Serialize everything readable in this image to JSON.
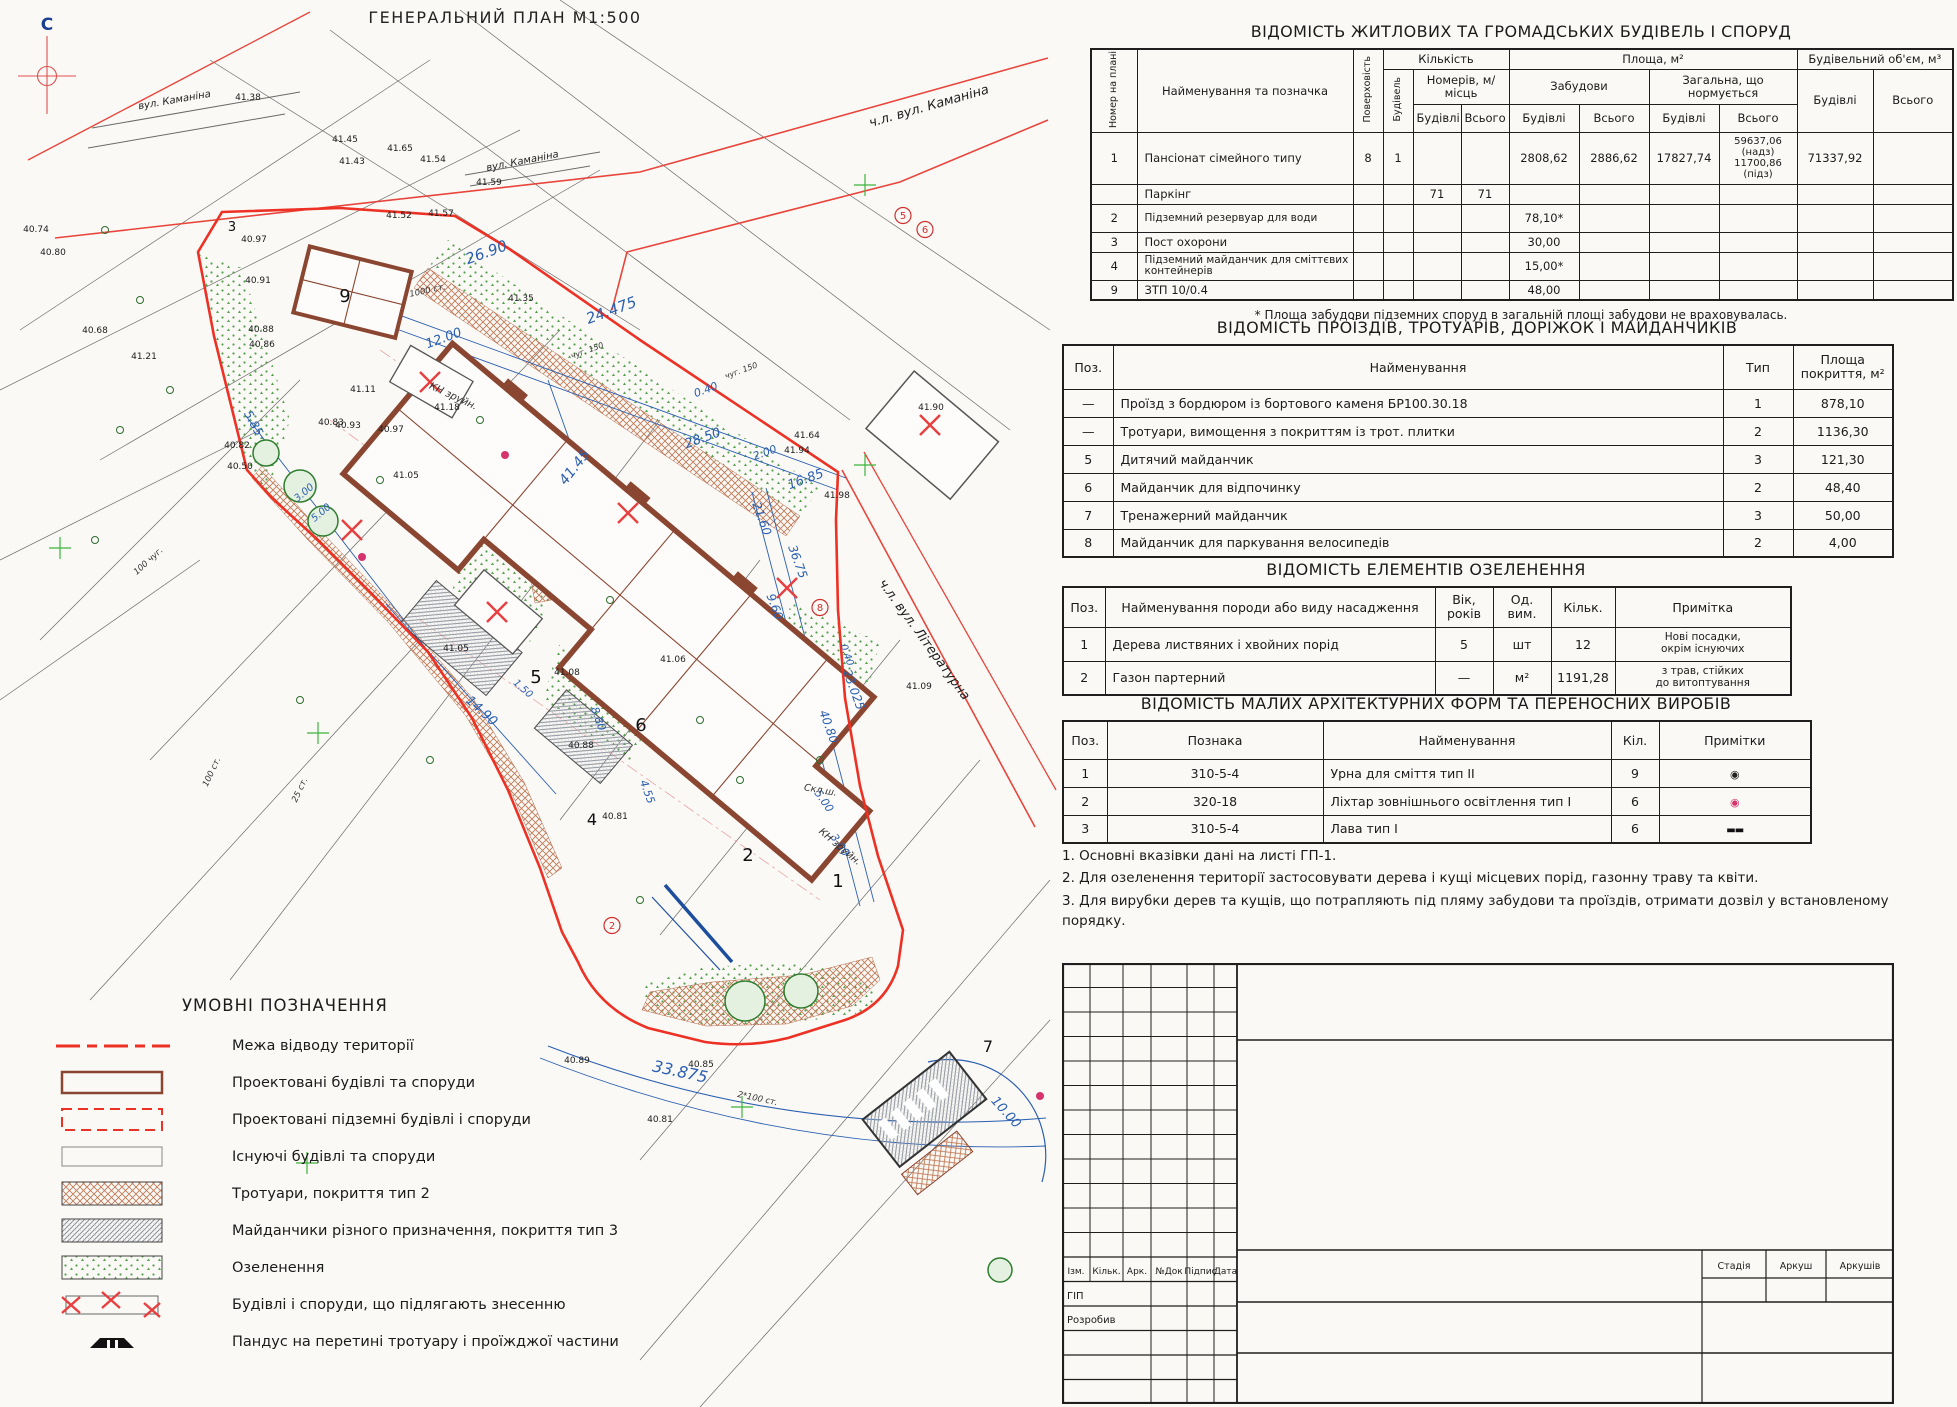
{
  "page": {
    "plan_title": "ГЕНЕРАЛЬНИЙ ПЛАН М1:500"
  },
  "tables": {
    "buildings": {
      "title": "ВІДОМІСТЬ ЖИТЛОВИХ ТА ГРОМАДСЬКИХ БУДІВЕЛЬ І СПОРУД",
      "headers": {
        "num": "Номер на плані",
        "name": "Найменування та позначка",
        "floors": "Поверховість",
        "qty": "Кількість",
        "bld_count": "Будівель",
        "rooms": "Номерів, м/місць",
        "area": "Площа, м²",
        "built": "Забудови",
        "total_norm": "Загальна, що нормується",
        "volume": "Будівельний об'єм, м³",
        "bld": "Будівлі",
        "all": "Всього"
      },
      "rows": [
        {
          "n": "1",
          "name": "Пансіонат сімейного типу",
          "fl": "8",
          "qb": "1",
          "zb": "2808,62",
          "zv": "2886,62",
          "gb": "17827,74",
          "gv": "59637,06\n(надз)\n11700,86\n(підз)",
          "vb": "71337,92"
        },
        {
          "n": "",
          "name": "Паркінг",
          "nb": "71",
          "nv": "71"
        },
        {
          "n": "2",
          "name": "Підземний резервуар для води",
          "zb": "78,10*"
        },
        {
          "n": "3",
          "name": "Пост охорони",
          "zb": "30,00"
        },
        {
          "n": "4",
          "name": "Підземний майданчик для сміттєвих контейнерів",
          "zb": "15,00*"
        },
        {
          "n": "9",
          "name": "ЗТП 10/0.4",
          "zb": "48,00"
        }
      ],
      "footnote": "* Площа забудови підземних споруд в загальній площі забудови не враховувалась."
    },
    "drives": {
      "title": "ВІДОМІСТЬ ПРОЇЗДІВ, ТРОТУАРІВ, ДОРІЖОК І МАЙДАНЧИКІВ",
      "headers": {
        "pos": "Поз.",
        "name": "Найменування",
        "type": "Тип",
        "area": "Площа\nпокриття, м²"
      },
      "rows": [
        {
          "p": "—",
          "n": "Проїзд з бордюром із бортового каменя БР100.30.18",
          "t": "1",
          "a": "878,10"
        },
        {
          "p": "—",
          "n": "Тротуари, вимощення з покриттям із трот. плитки",
          "t": "2",
          "a": "1136,30"
        },
        {
          "p": "5",
          "n": "Дитячий майданчик",
          "t": "3",
          "a": "121,30"
        },
        {
          "p": "6",
          "n": "Майданчик для відпочинку",
          "t": "2",
          "a": "48,40"
        },
        {
          "p": "7",
          "n": "Тренажерний майданчик",
          "t": "3",
          "a": "50,00"
        },
        {
          "p": "8",
          "n": "Майданчик для паркування велосипедів",
          "t": "2",
          "a": "4,00"
        }
      ]
    },
    "greenery": {
      "title": "ВІДОМІСТЬ ЕЛЕМЕНТІВ ОЗЕЛЕНЕННЯ",
      "headers": {
        "pos": "Поз.",
        "name": "Найменування породи або виду насадження",
        "age": "Вік,\nроків",
        "unit": "Од.\nвим.",
        "qty": "Кільк.",
        "note": "Примітка"
      },
      "rows": [
        {
          "p": "1",
          "n": "Дерева листвяних і хвойних порід",
          "a": "5",
          "u": "шт",
          "q": "12",
          "note": "Нові посадки,\nокрім існуючих"
        },
        {
          "p": "2",
          "n": "Газон партерний",
          "a": "—",
          "u": "м²",
          "q": "1191,28",
          "note": "з трав, стійких\nдо витоптування"
        }
      ]
    },
    "maf": {
      "title": "ВІДОМІСТЬ МАЛИХ АРХІТЕКТУРНИХ ФОРМ ТА ПЕРЕНОСНИХ ВИРОБІВ",
      "headers": {
        "pos": "Поз.",
        "mark": "Познака",
        "name": "Найменування",
        "qty": "Кіл.",
        "notes": "Примітки"
      },
      "rows": [
        {
          "p": "1",
          "m": "310-5-4",
          "n": "Урна для сміття тип II",
          "q": "9",
          "sym": "◉"
        },
        {
          "p": "2",
          "m": "320-18",
          "n": "Ліхтар зовнішнього освітлення тип I",
          "q": "6",
          "sym": "◉"
        },
        {
          "p": "3",
          "m": "310-5-4",
          "n": "Лава тип I",
          "q": "6",
          "sym": "▬▬"
        }
      ]
    }
  },
  "notes": [
    "1. Основні вказівки дані на листі ГП-1.",
    "2. Для озеленення території застосовувати дерева і кущі місцевих порід, газонну траву та квіти.",
    "3. Для вирубки дерев та кущів, що потрапляють під пляму забудови та проїздів, отримати дозвіл у встановленому порядку."
  ],
  "legend": {
    "title": "УМОВНІ ПОЗНАЧЕННЯ",
    "items": [
      {
        "label": "Межа відводу території"
      },
      {
        "label": "Проектовані будівлі та споруди"
      },
      {
        "label": "Проектовані підземні будівлі і споруди"
      },
      {
        "label": "Існуючі будівлі та споруди"
      },
      {
        "label": "Тротуари, покриття тип 2"
      },
      {
        "label": "Майданчики різного призначення, покриття тип 3"
      },
      {
        "label": "Озеленення"
      },
      {
        "label": "Будівлі і споруди, що підлягають знесенню"
      },
      {
        "label": "Пандус на перетині тротуару і проїжджої частини"
      }
    ]
  },
  "stamp": {
    "cols": [
      "Ізм.",
      "Кільк.",
      "Арк.",
      "№Док",
      "Підпис",
      "Дата"
    ],
    "roles": [
      "ГІП",
      "Розробив"
    ],
    "right": [
      "Стадія",
      "Аркуш",
      "Аркушів"
    ]
  },
  "colors": {
    "boundary_red": "#ed3124",
    "building_brown": "#8a4631",
    "dim_blue": "#2b5fb0",
    "greenery": "#57a04e"
  },
  "plan": {
    "labels": [
      {
        "x": 47,
        "y": 30,
        "t": "С",
        "c": "north",
        "s": 17
      },
      {
        "x": 175,
        "y": 103,
        "t": "вул. Каманіна",
        "c": "street",
        "r": -10,
        "s": 10
      },
      {
        "x": 523,
        "y": 164,
        "t": "вул. Каманіна",
        "c": "street",
        "r": -11,
        "s": 10
      },
      {
        "x": 930,
        "y": 110,
        "t": "ч.л. вул. Каманіна",
        "c": "axis",
        "r": -16,
        "s": 13
      },
      {
        "x": 921,
        "y": 642,
        "t": "ч.л. вул. Літературна",
        "c": "axis",
        "r": 54,
        "s": 13
      },
      {
        "x": 488,
        "y": 257,
        "t": "26.90",
        "c": "dim",
        "r": -20,
        "s": 15
      },
      {
        "x": 613,
        "y": 315,
        "t": "24.475",
        "c": "dim",
        "r": -20,
        "s": 15
      },
      {
        "x": 445,
        "y": 342,
        "t": "12.00",
        "c": "dim",
        "r": -20,
        "s": 13
      },
      {
        "x": 707,
        "y": 393,
        "t": "0.40",
        "c": "dim",
        "r": -20,
        "s": 11
      },
      {
        "x": 704,
        "y": 442,
        "t": "28.50",
        "c": "dim",
        "r": -20,
        "s": 13
      },
      {
        "x": 766,
        "y": 456,
        "t": "2.00",
        "c": "dim",
        "r": -20,
        "s": 11
      },
      {
        "x": 807,
        "y": 483,
        "t": "16.85",
        "c": "dim",
        "r": -20,
        "s": 13
      },
      {
        "x": 578,
        "y": 470,
        "t": "41.45",
        "c": "dim",
        "r": -52,
        "s": 14
      },
      {
        "x": 758,
        "y": 520,
        "t": "21.60",
        "c": "dim",
        "r": 70,
        "s": 12
      },
      {
        "x": 794,
        "y": 563,
        "t": "36.75",
        "c": "dim",
        "r": 70,
        "s": 12
      },
      {
        "x": 771,
        "y": 608,
        "t": "9.60",
        "c": "dim",
        "r": 70,
        "s": 12
      },
      {
        "x": 844,
        "y": 656,
        "t": "0.40",
        "c": "dim",
        "r": 70,
        "s": 10
      },
      {
        "x": 850,
        "y": 691,
        "t": "23.025",
        "c": "dim",
        "r": 70,
        "s": 12
      },
      {
        "x": 825,
        "y": 728,
        "t": "40.80",
        "c": "dim",
        "r": 70,
        "s": 12
      },
      {
        "x": 821,
        "y": 803,
        "t": "5.00",
        "c": "dim",
        "r": 55,
        "s": 11
      },
      {
        "x": 837,
        "y": 847,
        "t": "3.00",
        "c": "dim",
        "r": 55,
        "s": 11
      },
      {
        "x": 250,
        "y": 425,
        "t": "5.85",
        "c": "dim",
        "r": 62,
        "s": 12
      },
      {
        "x": 306,
        "y": 495,
        "t": "3.00",
        "c": "dim",
        "r": -40,
        "s": 10
      },
      {
        "x": 323,
        "y": 515,
        "t": "5.00",
        "c": "dim",
        "r": -40,
        "s": 10
      },
      {
        "x": 479,
        "y": 714,
        "t": "14.90",
        "c": "dim",
        "r": 42,
        "s": 13
      },
      {
        "x": 521,
        "y": 691,
        "t": "1.50",
        "c": "dim",
        "r": 42,
        "s": 10
      },
      {
        "x": 595,
        "y": 720,
        "t": "8.80",
        "c": "dim",
        "r": 70,
        "s": 11
      },
      {
        "x": 644,
        "y": 793,
        "t": "4.55",
        "c": "dim",
        "r": 70,
        "s": 11
      },
      {
        "x": 679,
        "y": 1077,
        "t": "33.875",
        "c": "dim",
        "r": 12,
        "s": 16
      },
      {
        "x": 1003,
        "y": 1115,
        "t": "10.00",
        "c": "dim",
        "r": 48,
        "s": 13
      },
      {
        "x": 248,
        "y": 100,
        "t": "41.38",
        "c": "elev",
        "s": 9
      },
      {
        "x": 345,
        "y": 142,
        "t": "41.45",
        "c": "elev",
        "s": 9
      },
      {
        "x": 352,
        "y": 164,
        "t": "41.43",
        "c": "elev",
        "s": 9
      },
      {
        "x": 400,
        "y": 151,
        "t": "41.65",
        "c": "elev",
        "s": 9
      },
      {
        "x": 433,
        "y": 162,
        "t": "41.54",
        "c": "elev",
        "s": 9
      },
      {
        "x": 489,
        "y": 185,
        "t": "41.59",
        "c": "elev",
        "s": 9
      },
      {
        "x": 399,
        "y": 218,
        "t": "41.52",
        "c": "elev",
        "s": 9
      },
      {
        "x": 441,
        "y": 216,
        "t": "41.57",
        "c": "elev",
        "s": 9
      },
      {
        "x": 521,
        "y": 301,
        "t": "41.35",
        "c": "elev",
        "s": 9
      },
      {
        "x": 36,
        "y": 232,
        "t": "40.74",
        "c": "elev",
        "s": 9
      },
      {
        "x": 53,
        "y": 255,
        "t": "40.80",
        "c": "elev",
        "s": 9
      },
      {
        "x": 254,
        "y": 242,
        "t": "40.97",
        "c": "elev",
        "s": 9
      },
      {
        "x": 258,
        "y": 283,
        "t": "40.91",
        "c": "elev",
        "s": 9
      },
      {
        "x": 261,
        "y": 332,
        "t": "40.88",
        "c": "elev",
        "s": 9
      },
      {
        "x": 262,
        "y": 347,
        "t": "40.86",
        "c": "elev",
        "s": 9
      },
      {
        "x": 331,
        "y": 425,
        "t": "40.83",
        "c": "elev",
        "s": 9
      },
      {
        "x": 348,
        "y": 428,
        "t": "40.93",
        "c": "elev",
        "s": 9
      },
      {
        "x": 391,
        "y": 432,
        "t": "40.97",
        "c": "elev",
        "s": 9
      },
      {
        "x": 237,
        "y": 448,
        "t": "40.82",
        "c": "elev",
        "s": 9
      },
      {
        "x": 240,
        "y": 469,
        "t": "40.50",
        "c": "elev",
        "s": 9
      },
      {
        "x": 95,
        "y": 333,
        "t": "40.68",
        "c": "elev",
        "s": 9
      },
      {
        "x": 144,
        "y": 359,
        "t": "41.21",
        "c": "elev",
        "s": 9
      },
      {
        "x": 406,
        "y": 478,
        "t": "41.05",
        "c": "elev",
        "s": 9
      },
      {
        "x": 363,
        "y": 392,
        "t": "41.11",
        "c": "elev",
        "s": 9
      },
      {
        "x": 447,
        "y": 410,
        "t": "41.18",
        "c": "elev",
        "s": 9
      },
      {
        "x": 456,
        "y": 651,
        "t": "41.05",
        "c": "elev",
        "s": 9
      },
      {
        "x": 567,
        "y": 675,
        "t": "41.08",
        "c": "elev",
        "s": 9
      },
      {
        "x": 581,
        "y": 748,
        "t": "40.88",
        "c": "elev",
        "s": 9
      },
      {
        "x": 615,
        "y": 819,
        "t": "40.81",
        "c": "elev",
        "s": 9
      },
      {
        "x": 673,
        "y": 662,
        "t": "41.06",
        "c": "elev",
        "s": 9
      },
      {
        "x": 701,
        "y": 1067,
        "t": "40.85",
        "c": "elev",
        "s": 9
      },
      {
        "x": 577,
        "y": 1063,
        "t": "40.89",
        "c": "elev",
        "s": 9
      },
      {
        "x": 660,
        "y": 1122,
        "t": "40.81",
        "c": "elev",
        "s": 9
      },
      {
        "x": 931,
        "y": 410,
        "t": "41.90",
        "c": "elev",
        "s": 9
      },
      {
        "x": 837,
        "y": 498,
        "t": "41.98",
        "c": "elev",
        "s": 9
      },
      {
        "x": 797,
        "y": 453,
        "t": "41.94",
        "c": "elev",
        "s": 9
      },
      {
        "x": 807,
        "y": 438,
        "t": "41.64",
        "c": "elev",
        "s": 9
      },
      {
        "x": 919,
        "y": 689,
        "t": "41.09",
        "c": "elev",
        "s": 9
      },
      {
        "x": 345,
        "y": 302,
        "t": "9",
        "c": "big",
        "s": 18
      },
      {
        "x": 232,
        "y": 231,
        "t": "3",
        "c": "big",
        "s": 13
      },
      {
        "x": 536,
        "y": 683,
        "t": "5",
        "c": "big",
        "s": 18
      },
      {
        "x": 641,
        "y": 731,
        "t": "6",
        "c": "big",
        "s": 18
      },
      {
        "x": 748,
        "y": 861,
        "t": "2",
        "c": "big",
        "s": 18
      },
      {
        "x": 592,
        "y": 825,
        "t": "4",
        "c": "big",
        "s": 16
      },
      {
        "x": 838,
        "y": 887,
        "t": "1",
        "c": "big",
        "s": 18
      },
      {
        "x": 988,
        "y": 1052,
        "t": "7",
        "c": "big",
        "s": 16
      },
      {
        "x": 903,
        "y": 219,
        "t": "5",
        "c": "circ",
        "s": 10
      },
      {
        "x": 925,
        "y": 233,
        "t": "6",
        "c": "circ",
        "s": 10
      },
      {
        "x": 820,
        "y": 611,
        "t": "8",
        "c": "circ",
        "s": 10
      },
      {
        "x": 612,
        "y": 929,
        "t": "2",
        "c": "circ",
        "s": 10
      },
      {
        "x": 452,
        "y": 399,
        "t": "КН зруйн.",
        "c": "misc",
        "r": 25,
        "s": 10
      },
      {
        "x": 838,
        "y": 849,
        "t": "КН зруйн.",
        "c": "misc",
        "r": 40,
        "s": 10
      },
      {
        "x": 820,
        "y": 793,
        "t": "Скл.ш.",
        "c": "misc",
        "r": 10,
        "s": 9.5
      },
      {
        "x": 150,
        "y": 563,
        "t": "100 чуг.",
        "c": "misc",
        "r": -42,
        "s": 8.5
      },
      {
        "x": 757,
        "y": 1101,
        "t": "2*100 ст.",
        "c": "misc",
        "r": 12,
        "s": 8.5
      },
      {
        "x": 214,
        "y": 773,
        "t": "100 ст.",
        "c": "misc",
        "r": -65,
        "s": 8.5
      },
      {
        "x": 302,
        "y": 791,
        "t": "25 ст.",
        "c": "misc",
        "r": -65,
        "s": 8.5
      },
      {
        "x": 428,
        "y": 293,
        "t": "1000 ст.",
        "c": "misc",
        "r": -12,
        "s": 8.5
      },
      {
        "x": 588,
        "y": 353,
        "t": "чуг. 150",
        "c": "misc",
        "r": -20,
        "s": 8
      },
      {
        "x": 742,
        "y": 373,
        "t": "чуг. 150",
        "c": "misc",
        "r": -20,
        "s": 8
      }
    ]
  }
}
